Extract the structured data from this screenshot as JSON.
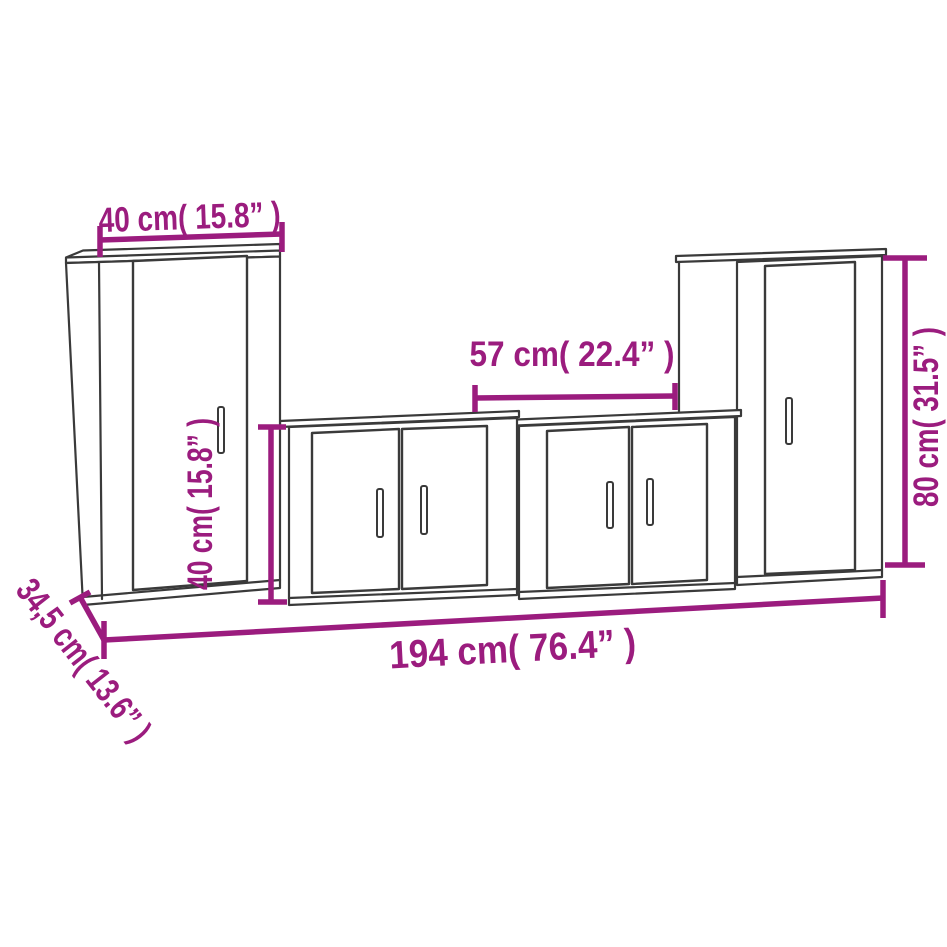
{
  "colors": {
    "background": "#ffffff",
    "outline": "#3a3a3a",
    "accent": "#9b1c7e"
  },
  "diagram": {
    "dimensions": {
      "top_width": "40 cm( 15.8” )",
      "unit_width": "57 cm( 22.4” )",
      "tall_height": "80 cm( 31.5” )",
      "short_height": "40 cm( 15.8” )",
      "depth": "34,5 cm( 13.6” )",
      "total_width": "194 cm( 76.4” )"
    }
  }
}
